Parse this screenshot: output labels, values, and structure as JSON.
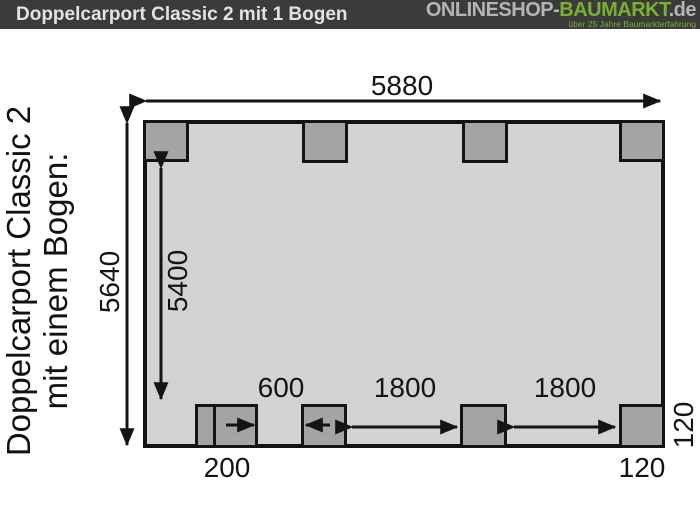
{
  "header": {
    "title": "Doppelcarport Classic 2 mit 1 Bogen",
    "logo": {
      "shop_name_prefix": "ONLINESHOP-",
      "shop_name_accent": "BAUMARKT",
      "shop_name_tld": ".de",
      "tagline": "über 25 Jahre Baumarkterfahrung"
    }
  },
  "caption": {
    "line1": "Doppelcarport Classic 2",
    "line2": "mit einem Bogen:"
  },
  "diagram": {
    "type": "carport floor plan, top view",
    "dimensions": {
      "total_width": "5880",
      "total_depth": "5640",
      "clear_depth": "5400",
      "front_gap_small": "600",
      "front_gap_a": "1800",
      "front_gap_b": "1800",
      "front_offset": "200",
      "post_size_bottom": "120",
      "post_size_right": "120"
    }
  },
  "colors": {
    "top_bar_bg": "#3b3b3b",
    "accent_green": "#78b22b",
    "plan_fill": "#d2d2d2",
    "post_fill": "#a4a4a4",
    "line": "#141414"
  }
}
